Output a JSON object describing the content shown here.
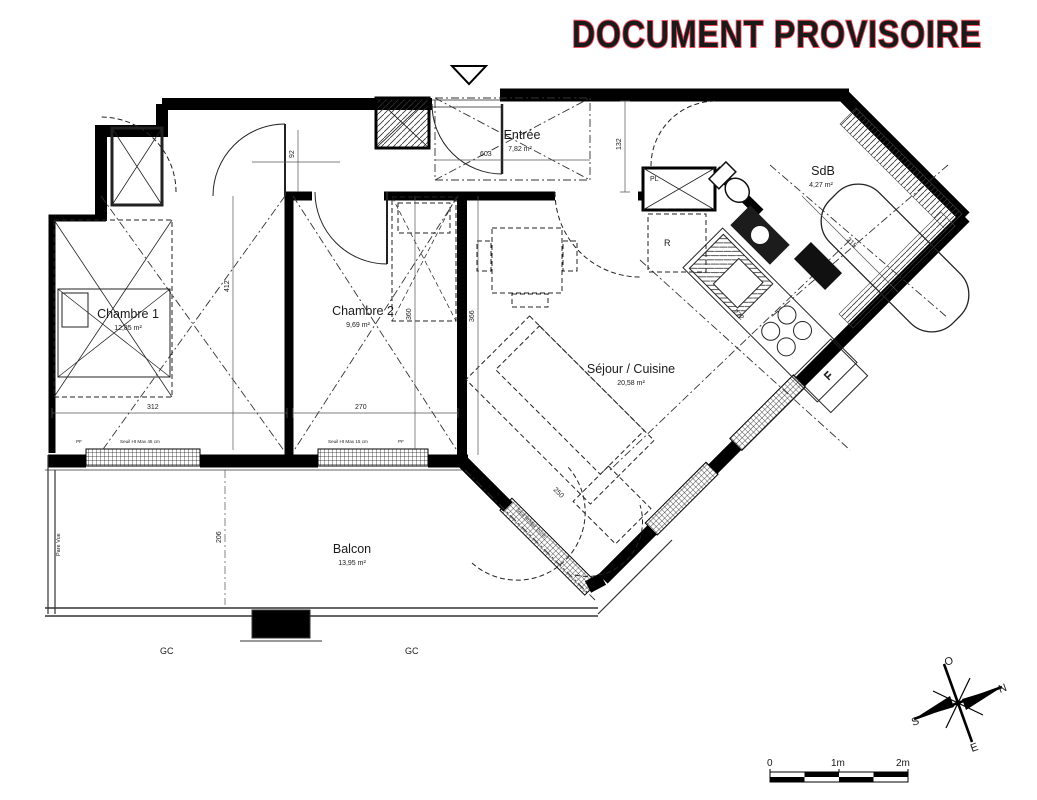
{
  "watermark": {
    "text": "DOCUMENT PROVISOIRE",
    "color": "#f3505e"
  },
  "rooms": {
    "chambre1": {
      "name": "Chambre 1",
      "area": "12,85 m²"
    },
    "chambre2": {
      "name": "Chambre 2",
      "area": "9,69 m²"
    },
    "entree": {
      "name": "Entrée",
      "area": "7,82 m²"
    },
    "sdb": {
      "name": "SdB",
      "area": "4,27 m²"
    },
    "sejour": {
      "name": "Séjour / Cuisine",
      "area": "20,58 m²"
    },
    "balcon": {
      "name": "Balcon",
      "area": "13,95 m²"
    }
  },
  "fixtures": {
    "placard": "PL",
    "fridge": "R",
    "washer": "LL"
  },
  "railing": {
    "gc1": "GC",
    "gc2": "GC",
    "pare_vue": "Pare Vue"
  },
  "dims": {
    "w92": "92",
    "w132": "132",
    "w603": "603",
    "w312": "312",
    "w270": "270",
    "w360": "360",
    "w366": "366",
    "w412": "412",
    "w206": "206",
    "w215": "215",
    "w272": "272",
    "w250": "250",
    "seuil45": "Seuil Ht Max 45 cm",
    "seuil15": "Seuil Ht Max 15 cm",
    "seuil15b": "Seuil Ht Max 15 cm",
    "pf1": "PF",
    "pf2": "PF"
  },
  "compass": {
    "n": "N",
    "s": "S",
    "e": "E",
    "o": "O"
  },
  "scalebar": {
    "zero": "0",
    "one": "1m",
    "two": "2m"
  }
}
